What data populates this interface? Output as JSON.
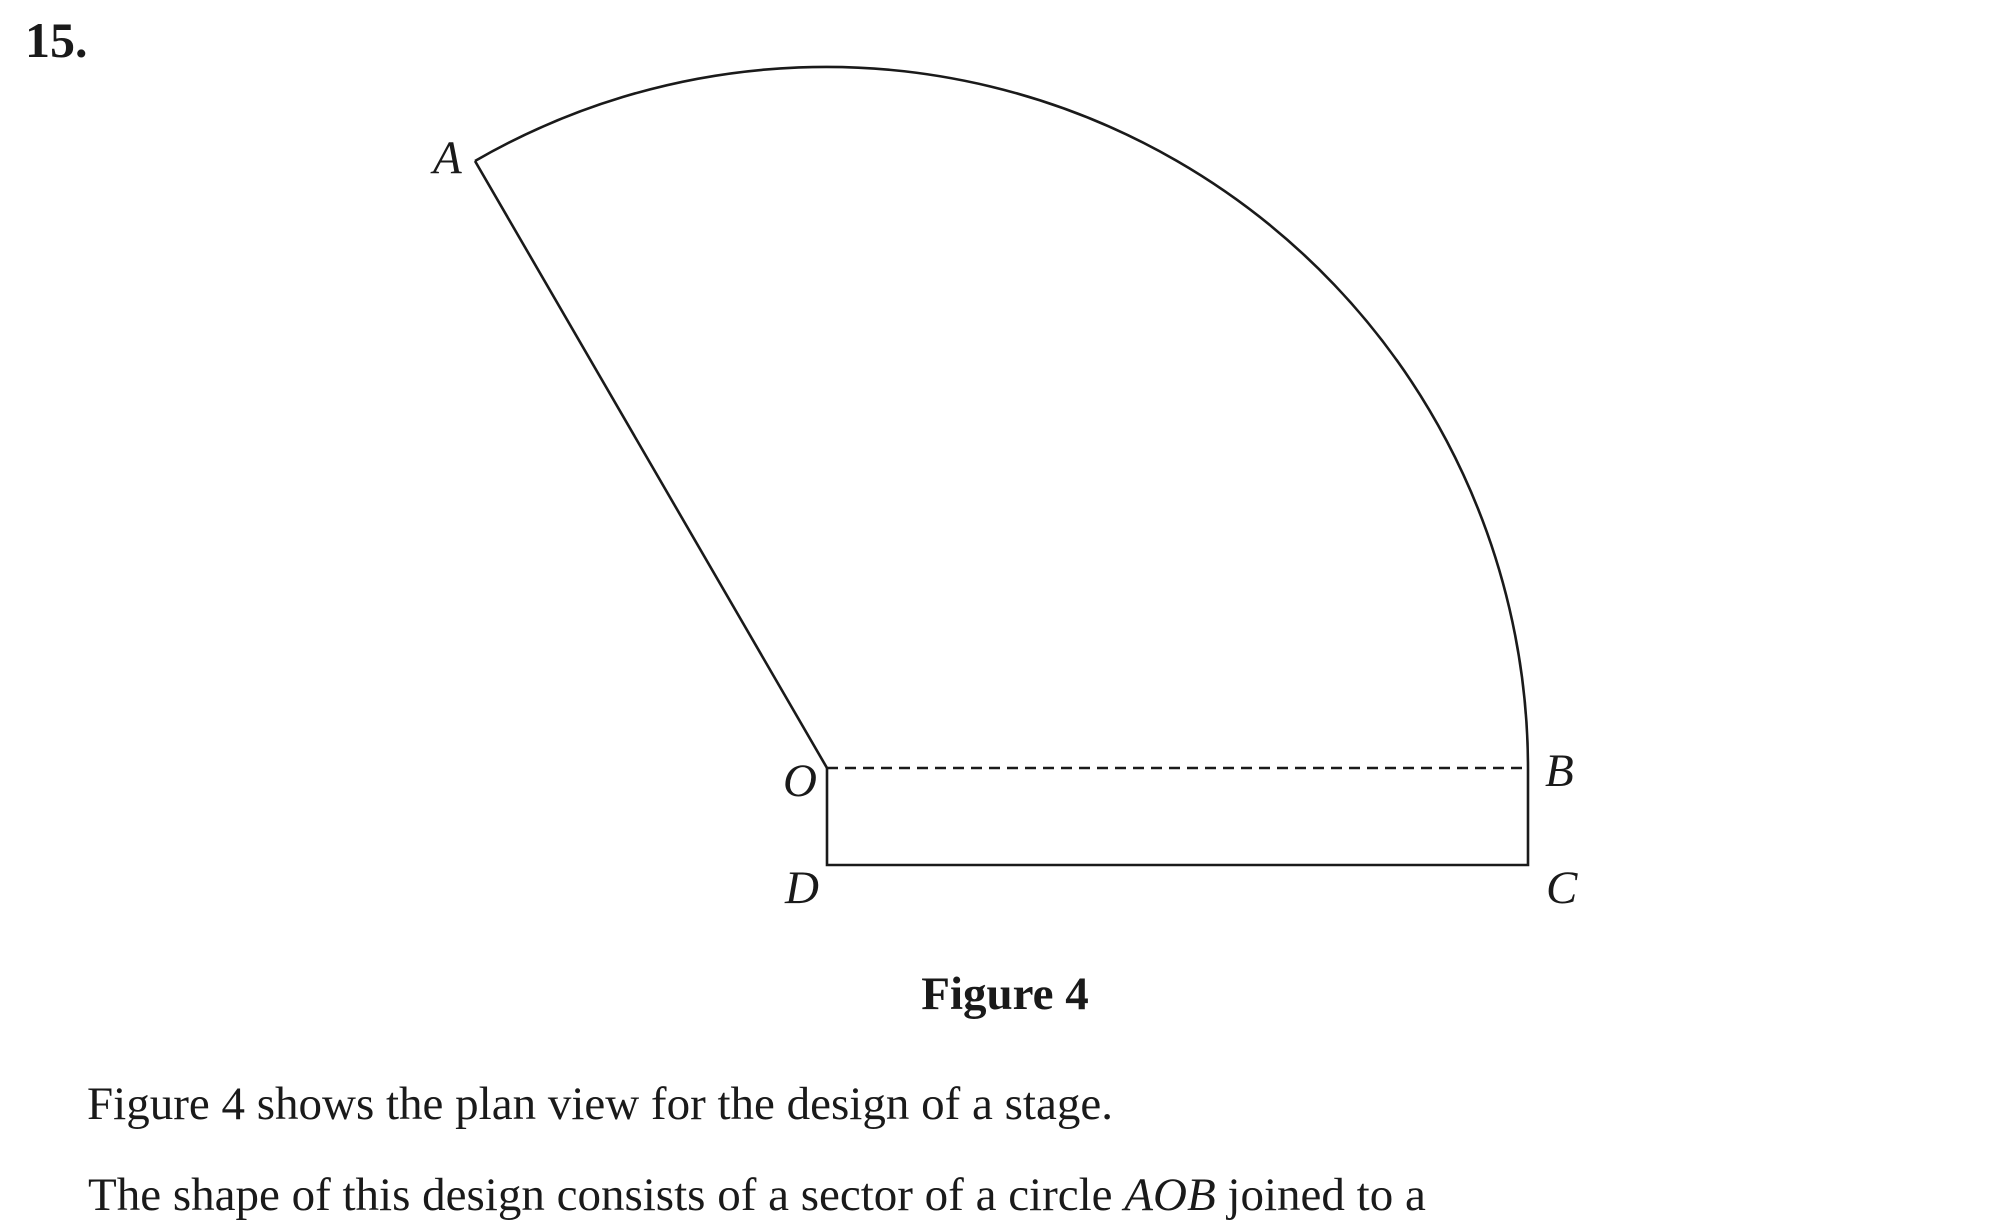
{
  "palette": {
    "background": "#ffffff",
    "ink": "#1a1a1a"
  },
  "question": {
    "number": "15."
  },
  "figure": {
    "caption": "Figure 4",
    "point_labels": {
      "A": "A",
      "O": "O",
      "B": "B",
      "C": "C",
      "D": "D"
    },
    "geometry": {
      "sector_center": {
        "x": 827,
        "y": 768
      },
      "radius": 702,
      "point_A": {
        "x": 475,
        "y": 161
      },
      "point_B": {
        "x": 1528,
        "y": 768
      },
      "rectangle": {
        "left": 827,
        "top": 768,
        "right": 1528,
        "bottom": 865
      },
      "dash_pattern": "11 7",
      "stroke_width": 2.6
    }
  },
  "body_text": {
    "line1": "Figure 4 shows the plan view for the design of a stage.",
    "line2_prefix": "The shape of this design consists of a sector of a circle ",
    "line2_italic": "AOB",
    "line2_suffix": " joined to a"
  }
}
